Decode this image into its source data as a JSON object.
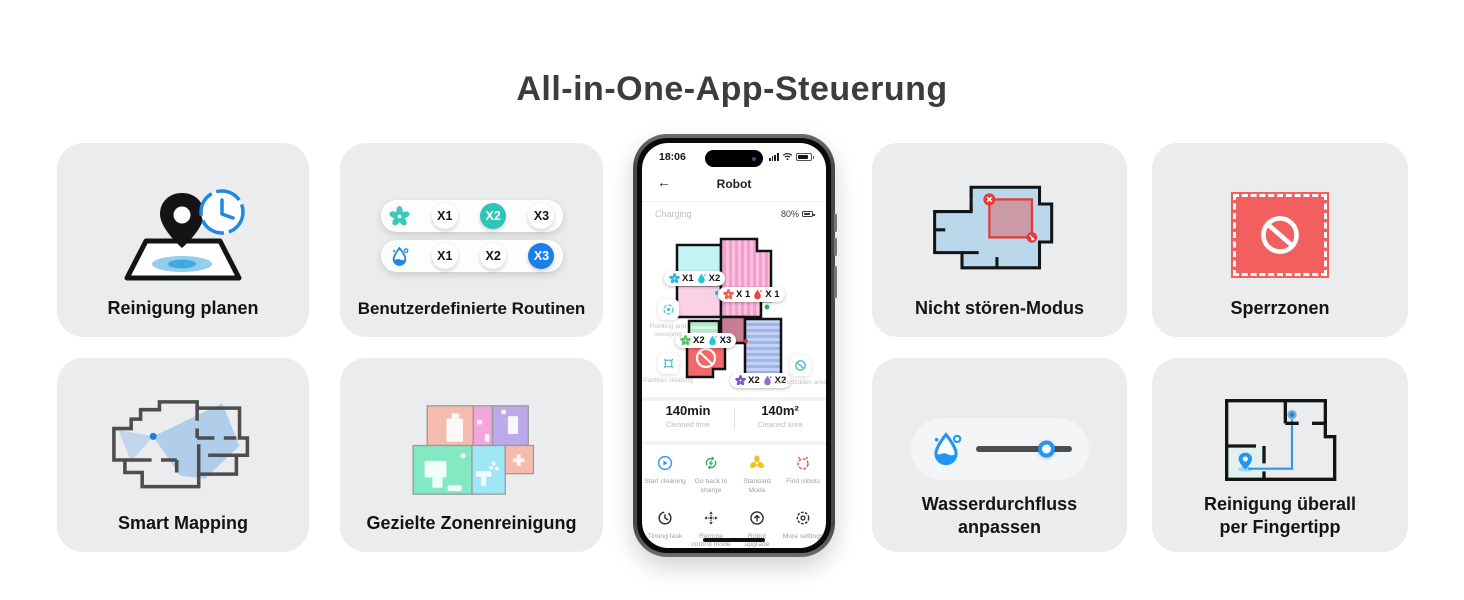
{
  "title": "All-in-One-App-Steuerung",
  "colors": {
    "card_bg": "#EBECED",
    "accent_blue": "#1E88E5",
    "accent_teal": "#2EC5B6",
    "alert_red": "#F25F5F",
    "map_pink": "#FBBFE0",
    "map_cyan": "#C4F2F5",
    "map_mint": "#D7F8E3",
    "map_periwinkle": "#C3D2F4"
  },
  "cards": {
    "schedule": {
      "label": "Reinigung planen"
    },
    "routines": {
      "label": "Benutzerdefinierte Routinen",
      "fan_row": {
        "options": [
          "X1",
          "X2",
          "X3"
        ],
        "selected": "X2"
      },
      "drop_row": {
        "options": [
          "X1",
          "X2",
          "X3"
        ],
        "selected": "X3"
      }
    },
    "dnd": {
      "label": "Nicht stören-Modus"
    },
    "nogo": {
      "label": "Sperrzonen"
    },
    "mapping": {
      "label": "Smart Mapping"
    },
    "zone": {
      "label": "Gezielte Zonenreinigung"
    },
    "water": {
      "label": "Wasserdurchfluss anpassen"
    },
    "tap": {
      "label": "Reinigung überall per Fingertipp"
    }
  },
  "phone": {
    "time": "18:06",
    "nav": {
      "back": "←",
      "title": "Robot"
    },
    "charging": {
      "label": "Charging",
      "battery": "80%"
    },
    "map_labels": [
      {
        "fan": "X1",
        "drop": "X2"
      },
      {
        "fan": "X 1",
        "drop": "X 1"
      },
      {
        "fan": "X2",
        "drop": "X3"
      },
      {
        "fan": "X2",
        "drop": "X2"
      }
    ],
    "features": [
      {
        "label": "Pointing and sweeping"
      },
      {
        "label": "Partition cleaning"
      },
      {
        "label": "Set forbidden area"
      }
    ],
    "stats": [
      {
        "value": "140min",
        "caption": "Cleaned time"
      },
      {
        "value": "140m²",
        "caption": "Cleaned area"
      }
    ],
    "actions": [
      {
        "label": "Start cleaning"
      },
      {
        "label": "Go back to charge"
      },
      {
        "label": "Standard Mode"
      },
      {
        "label": "Find robots"
      },
      {
        "label": "Timing task"
      },
      {
        "label": "Remote control mode"
      },
      {
        "label": "Robot upgrade"
      },
      {
        "label": "More settings"
      }
    ]
  }
}
